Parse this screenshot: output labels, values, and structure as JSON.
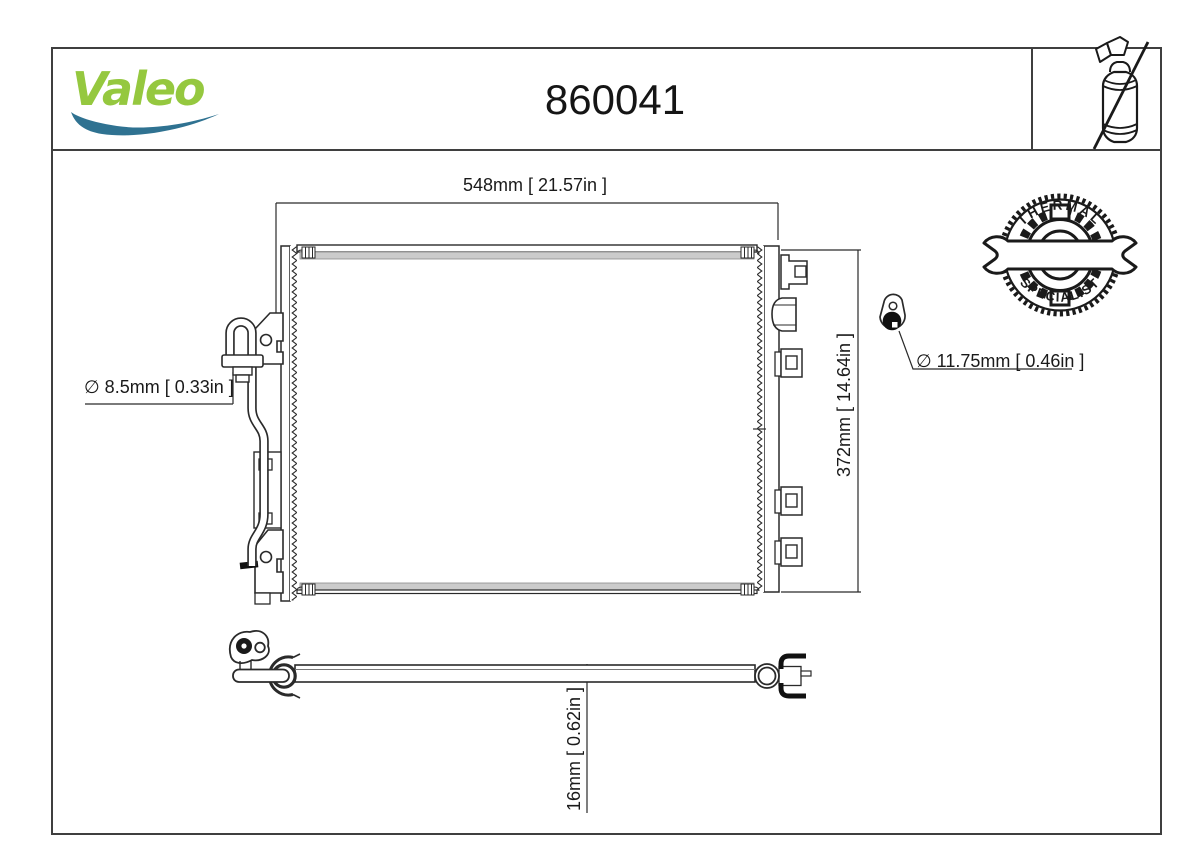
{
  "header": {
    "brand": "Valeo",
    "part_number": "860041"
  },
  "badge": {
    "top": "THERMAL",
    "bottom": "SPECIALIST"
  },
  "dimensions": {
    "width": "548mm [ 21.57in ]",
    "height": "372mm [ 14.64in ]",
    "depth": "16mm [ 0.62in ]",
    "pipe_diameter": "∅ 8.5mm [ 0.33in ]",
    "fitting_diameter": "∅ 11.75mm [ 0.46in ]"
  },
  "icons": {
    "no_drier": "crossed-out-spray-can",
    "badge": "wrench-and-gears-thermal-specialist",
    "swoosh": "valeo-brand-swoosh"
  },
  "colors": {
    "brand_green": "#95C83F",
    "brand_blue": "#2F7291",
    "line": "#2a2a2a",
    "frame": "#3f3f3f",
    "band_gray": "#cbcbcb"
  }
}
